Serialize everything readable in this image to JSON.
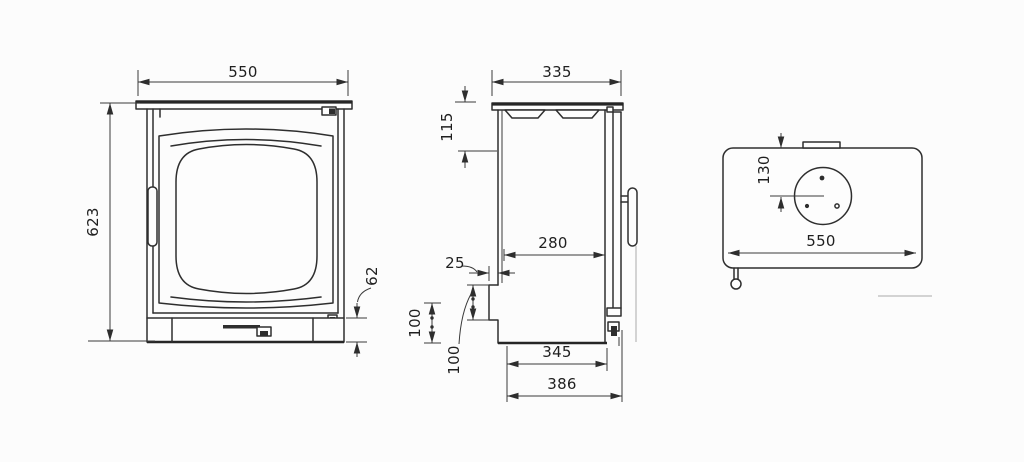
{
  "drawing_colors": {
    "line": "#2e2e2e",
    "dimension": "#3a3a3a",
    "background": "#fcfcfc"
  },
  "front_view": {
    "width": "550",
    "height": "623",
    "base_height": "62"
  },
  "side_view": {
    "depth": "335",
    "top_offset": "115",
    "body_depth": "280",
    "rear_offset": "25",
    "rear_height_upper": "100",
    "rear_height_lower": "100",
    "base_depth": "345",
    "overall_depth": "386"
  },
  "top_view": {
    "flue_offset": "130",
    "width": "550"
  }
}
